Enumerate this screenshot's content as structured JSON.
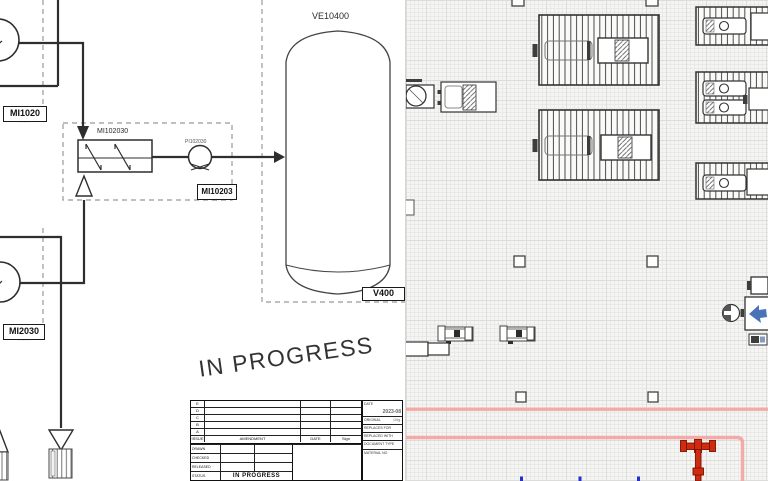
{
  "colors": {
    "pid_line": "#2e2e2e",
    "grid_bg": "#f5f5f3",
    "highlight_pink": "#f2aba6",
    "pipe_red": "#cf2b0e",
    "marker_blue": "#2330cc",
    "icon_blue": "#4a72b8"
  },
  "left_diagram": {
    "watermark": "IN PROGRESS",
    "equipment_labels": {
      "vessel_top": "VE10400",
      "heat_exchanger": "MI102030",
      "pump": "PI102030"
    },
    "tags": {
      "mi1020": {
        "label": "MI1020",
        "sub": "·····"
      },
      "mi2030": {
        "label": "MI2030",
        "sub": "·····"
      },
      "mi10203": {
        "label": "MI10203",
        "sub": "·····"
      },
      "v400": {
        "label": "V400",
        "sub": "·····"
      }
    },
    "titleblock": {
      "revision_rows": [
        "E",
        "D",
        "C",
        "B",
        "A"
      ],
      "header": {
        "issue": "ISSUE",
        "amendment": "AMENDMENT",
        "date": "DATE",
        "sign": "Sign"
      },
      "left_rows": {
        "drawn": "DRAWN",
        "checked": "CHECKED",
        "released": "RELEASED",
        "status": "STATUS"
      },
      "status_value": "IN PROGRESS",
      "right": {
        "date_label": "DATE",
        "date_value": "2023-08",
        "original_label": "ORIGINAL",
        "original_value": "Orig.",
        "replaces_for": "REPLACES FOR",
        "replaced_with": "REPLACED WITH",
        "document_type": "DOCUMENT TYPE",
        "material_no": "MATERIAL NO"
      }
    }
  },
  "right_diagram": {
    "pump_sublabel": "···"
  }
}
